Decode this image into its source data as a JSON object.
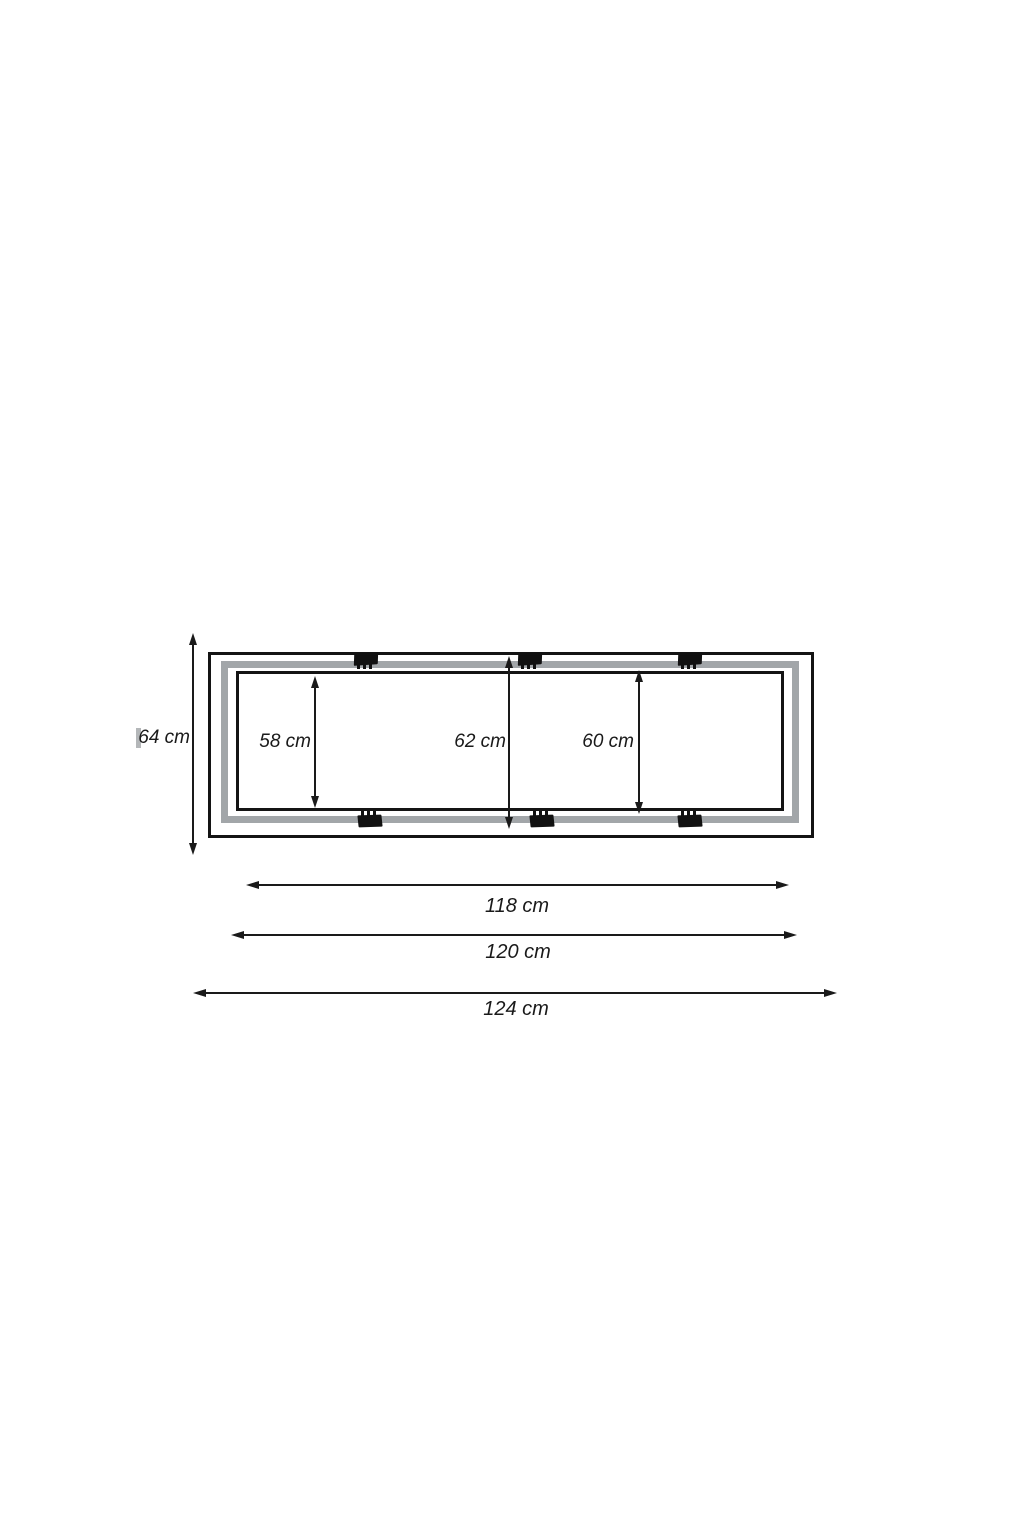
{
  "diagram": {
    "description": "frame dimension drawing",
    "unit": "cm",
    "vertical_dimensions": [
      {
        "id": "outer-height",
        "label": "64 cm"
      },
      {
        "id": "inner-left-height",
        "label": "58 cm"
      },
      {
        "id": "middle-height",
        "label": "62 cm"
      },
      {
        "id": "inner-right-height",
        "label": "60 cm"
      }
    ],
    "horizontal_dimensions": [
      {
        "id": "inner-width",
        "label": "118 cm"
      },
      {
        "id": "middle-width",
        "label": "120 cm"
      },
      {
        "id": "outer-width",
        "label": "124 cm"
      }
    ],
    "colors": {
      "line": "#1a1a1a",
      "frame_border": "#141414",
      "band": "#a2a6a9",
      "clip": "#111111",
      "tick": "#b4b7b9",
      "background": "#ffffff"
    },
    "clips": {
      "top_count": 3,
      "bottom_count": 3
    }
  }
}
